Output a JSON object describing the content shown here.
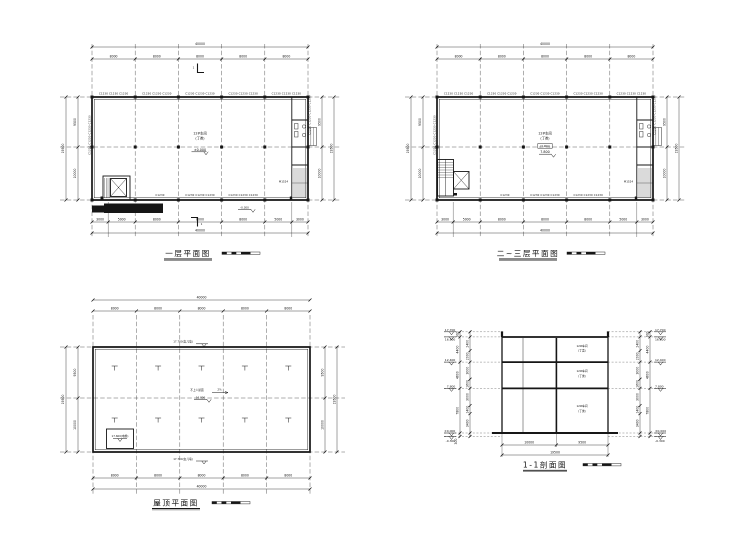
{
  "page": {
    "background": "#ffffff",
    "line_color": "#1a1a1a"
  },
  "shared": {
    "dim_total_w": "40000",
    "dim_bay": "8000",
    "dim_3000": "3000",
    "dim_5000": "5000",
    "dim_total_h": "19500",
    "dim_9500": "9500",
    "dim_10000": "10000",
    "win3": "C1230 C1230 C1230",
    "win4": "C1230 C1230 C1230 C1230",
    "win1": "C1230",
    "room": "12#车间",
    "room_class": "(丁类)"
  },
  "plan1": {
    "title": "一层平面图",
    "elev_main": "±0.000",
    "elev_out": "-0.300",
    "door": "M1524",
    "section_no": "1"
  },
  "plan2": {
    "title": "二~三层平面图",
    "elev_paren": "(3.900)",
    "elev_main": "7.800"
  },
  "roof": {
    "title": "屋顶平面图",
    "parapet": "17.700(女儿墙)",
    "note": "不上人屋面",
    "slope": "2%",
    "elev": "16.800",
    "shaft": "17.600(电梯)"
  },
  "section": {
    "title": "1-1剖面图",
    "levels": [
      "17.700",
      "16.800",
      "12.400",
      "7.800",
      "±0.000",
      "-0.300"
    ],
    "chain_outer": [
      "900",
      "4400",
      "4600",
      "7800",
      "300"
    ],
    "chain_inner": [
      "2400",
      "2000",
      "3000",
      "1600",
      "3000",
      "1400",
      "3400"
    ],
    "dim_left": "10000",
    "dim_right": "9500",
    "dim_total": "19500"
  }
}
